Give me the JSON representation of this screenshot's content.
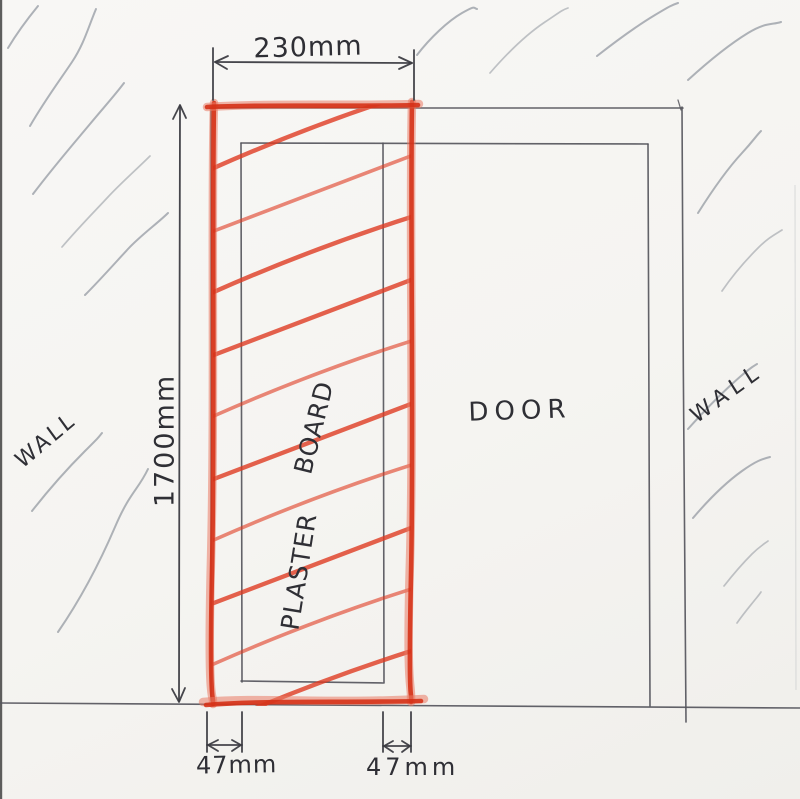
{
  "labels": {
    "wall_left": "WALL",
    "wall_right": "WALL",
    "door": "DOOR",
    "plaster": "PLASTER",
    "board": "BOARD"
  },
  "dimensions": {
    "top_width": "230mm",
    "left_height": "1700mm",
    "bottom_left_stud": "47mm",
    "bottom_right_stud": "47mm"
  },
  "colors": {
    "paper": "#f6f5f2",
    "pencil": "#55555c",
    "pencil_dark": "#3c3c42",
    "pencil_light": "#a0a5ab",
    "crayon_red": "#df3b22",
    "crayon_red_light": "#ea7a64",
    "crayon_red_dark": "#d52f14",
    "ink": "#2f2f35"
  }
}
